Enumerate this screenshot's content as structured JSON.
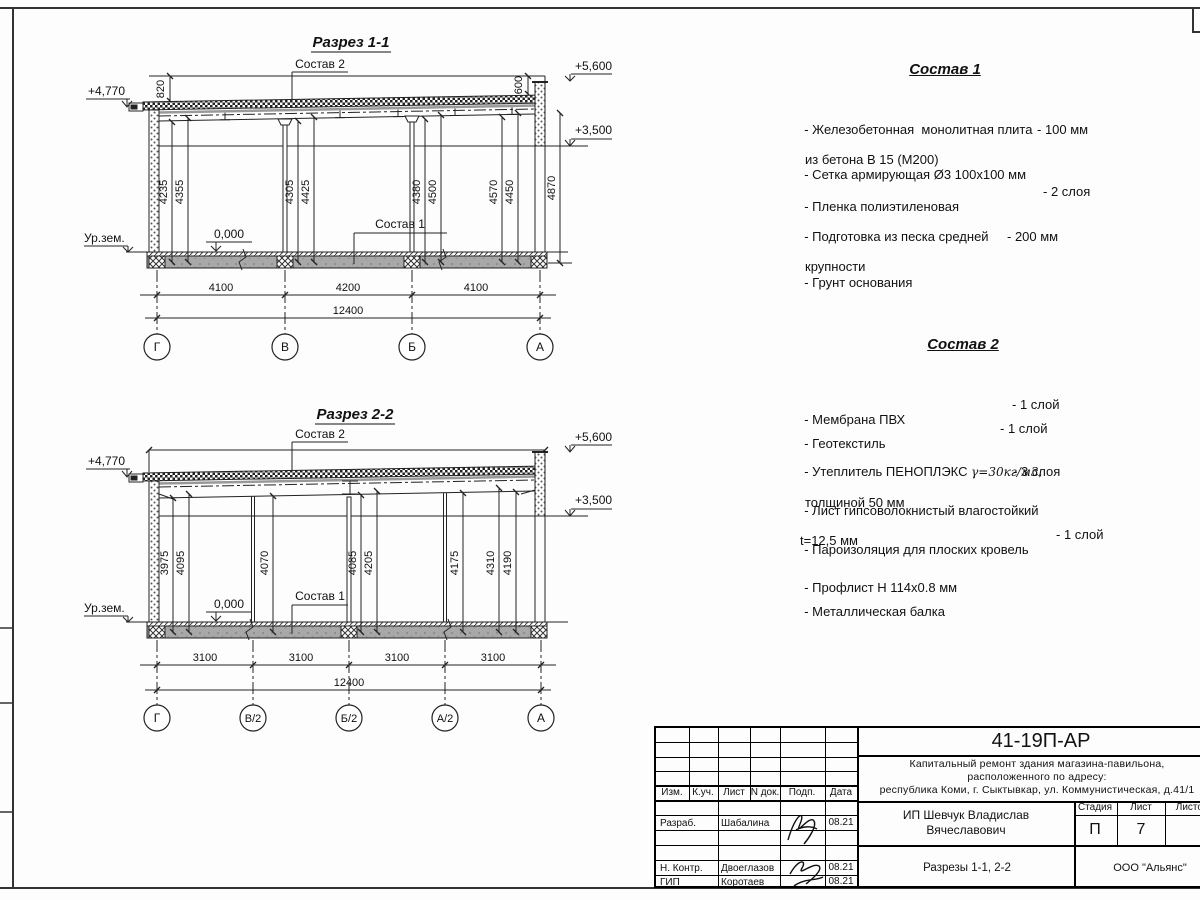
{
  "section1": {
    "title": "Разрез 1-1",
    "label_sostav2": "Состав 2",
    "label_sostav1": "Состав 1",
    "elev_left": "+4,770",
    "elev_top": "+5,600",
    "elev_mid": "+3,500",
    "dim_top_left": "820",
    "dim_top_right": "600",
    "label_ground": "Ур.зем.",
    "label_zero": "0,000",
    "vert_dims": [
      "4235",
      "4355",
      "4305",
      "4425",
      "4380",
      "4500",
      "4570",
      "4450",
      "4870"
    ],
    "bottom_dims": [
      "4100",
      "4200",
      "4100"
    ],
    "total": "12400",
    "axes": [
      "Г",
      "В",
      "Б",
      "А"
    ]
  },
  "section2": {
    "title": "Разрез 2-2",
    "label_sostav2": "Состав 2",
    "label_sostav1": "Состав 1",
    "elev_left": "+4,770",
    "elev_top": "+5,600",
    "elev_mid": "+3,500",
    "label_ground": "Ур.зем.",
    "label_zero": "0,000",
    "vert_dims": [
      "3975",
      "4095",
      "4070",
      "4085",
      "4205",
      "4175",
      "4310",
      "4190"
    ],
    "bottom_dims": [
      "3100",
      "3100",
      "3100",
      "3100"
    ],
    "total": "12400",
    "axes": [
      "Г",
      "В/2",
      "Б/2",
      "А/2",
      "А"
    ]
  },
  "sostav1": {
    "title": "Состав 1",
    "items": [
      {
        "line1": "- Железобетонная  монолитная плита",
        "line2": "из бетона В 15 (М200)",
        "value": "- 100 мм"
      },
      {
        "line1": "- Сетка армирующая Ø3 100х100 мм",
        "line2": "",
        "value": ""
      },
      {
        "line1": "- Пленка полиэтиленовая",
        "line2": "",
        "value": "- 2 слоя"
      },
      {
        "line1": "- Подготовка из песка средней",
        "line2": "крупности",
        "value": "- 200 мм"
      },
      {
        "line1": "- Грунт основания",
        "line2": "",
        "value": ""
      }
    ]
  },
  "sostav2": {
    "title": "Состав 2",
    "items": [
      {
        "line1": "- Мембрана ПВХ",
        "line2": "",
        "value": "- 1 слой"
      },
      {
        "line1": "- Геотекстиль",
        "line2": "",
        "value": "- 1 слой"
      },
      {
        "line1": "- Утеплитель ПЕНОПЛЭКС ",
        "gamma": "γ=30кг/м3,",
        "line2": "толщиной 50 мм",
        "value": "- 3 слоя"
      },
      {
        "line1": "- Лист гипсоволокнистый влагостойкий",
        "line2": "t=12,5 мм",
        "value": ""
      },
      {
        "line1": "- Пароизоляция для плоских кровель",
        "line2": "",
        "value": "- 1 слой"
      },
      {
        "line1": "- Профлист Н 114х0.8 мм",
        "line2": "",
        "value": ""
      },
      {
        "line1": "- Металлическая балка",
        "line2": "",
        "value": ""
      }
    ]
  },
  "titleblock": {
    "doc_number": "41-19П-АР",
    "desc_line1": "Капитальный ремонт здания магазина-павильона,",
    "desc_line2": "расположенного по адресу:",
    "desc_line3": "республика Коми, г. Сыктывкар, ул. Коммунистическая, д.41/1",
    "col_izm": "Изм.",
    "col_kuch": "К.уч.",
    "col_list": "Лист",
    "col_ndok": "N док.",
    "col_podp": "Подп.",
    "col_data": "Дата",
    "row1_role": "Разраб.",
    "row1_name": "Шабалина",
    "row1_date": "08.21",
    "row2_role": "Н. Контр.",
    "row2_name": "Двоеглазов",
    "row2_date": "08.21",
    "row3_role": "ГИП",
    "row3_name": "Коротаев",
    "row3_date": "08.21",
    "client_line1": "ИП Шевчук Владислав",
    "client_line2": "Вячеславович",
    "stage_h": "Стадия",
    "list_h": "Лист",
    "listov_h": "Листов",
    "stage_v": "П",
    "list_v": "7",
    "sheet_title": "Разрезы 1-1, 2-2",
    "org": "ООО \"Альянс\""
  }
}
